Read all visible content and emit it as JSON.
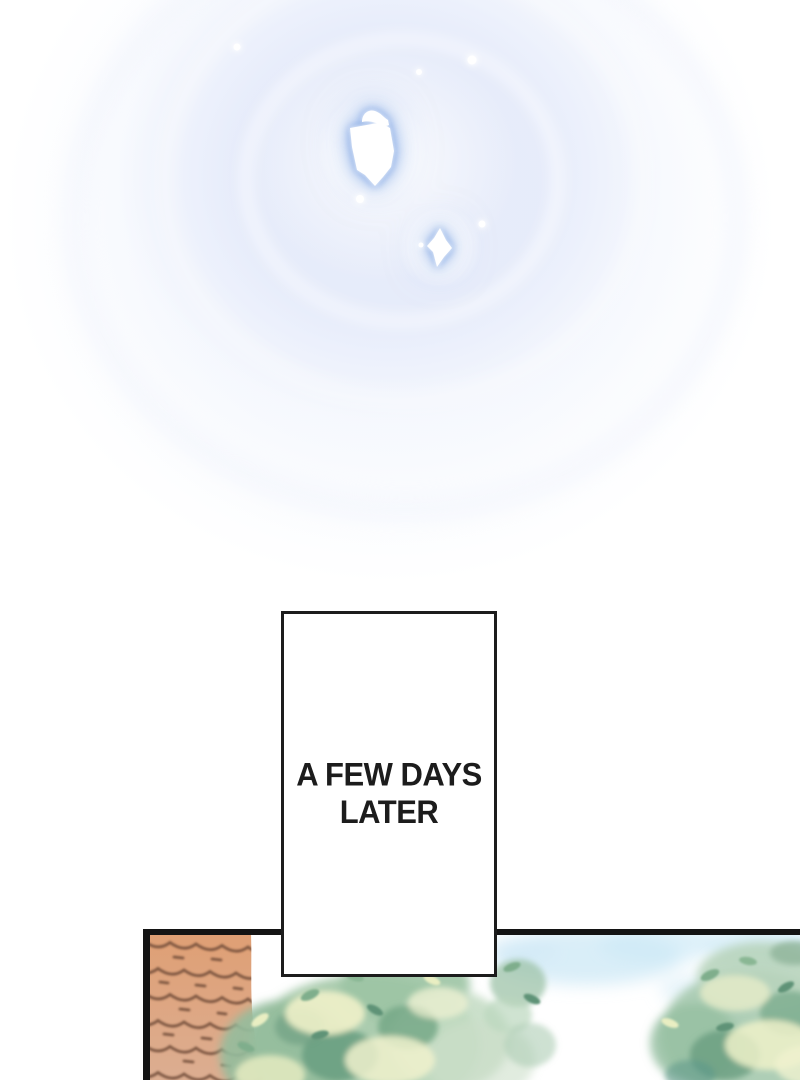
{
  "caption": {
    "full_text": "A FEW DAYS LATER",
    "line1": "A FEW DAYS",
    "line2": "LATER"
  },
  "colors": {
    "paper": "#ffffff",
    "ink": "#1c1c1c",
    "panel_border": "#141414",
    "glow_blue": "#7da3e2",
    "glow_field": "#e7ecf9",
    "roof_top": "#df9f74",
    "roof_bottom": "#dcae92",
    "roof_line": "#6f4b38",
    "foliage_base": "#a7c9ab",
    "foliage_pale": "#c2dac2",
    "foliage_dark": "#699d80",
    "foliage_highlight": "#eff1c9",
    "sky_patch": "#cfeaf6"
  }
}
